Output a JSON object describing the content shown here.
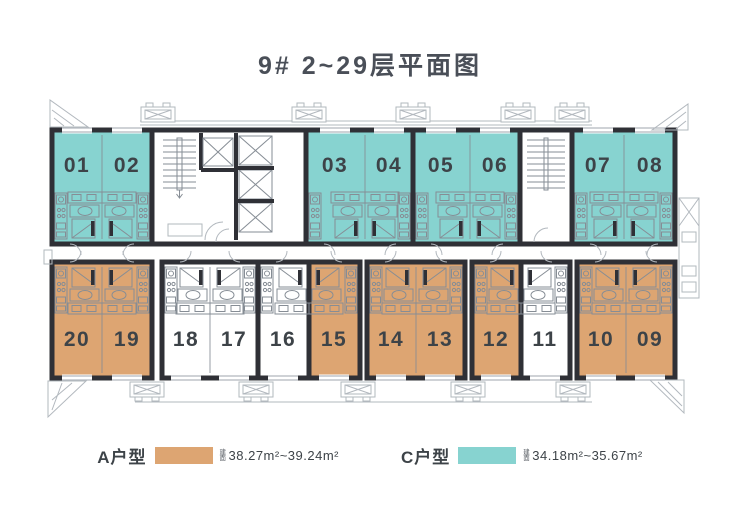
{
  "title": "9#  2~29层平面图",
  "units": {
    "top": [
      {
        "label": "01",
        "type": "C"
      },
      {
        "label": "02",
        "type": "C"
      },
      {
        "label": "03",
        "type": "C"
      },
      {
        "label": "04",
        "type": "C"
      },
      {
        "label": "05",
        "type": "C"
      },
      {
        "label": "06",
        "type": "C"
      },
      {
        "label": "07",
        "type": "C"
      },
      {
        "label": "08",
        "type": "C"
      }
    ],
    "bottom": [
      {
        "label": "20",
        "type": "A"
      },
      {
        "label": "19",
        "type": "A"
      },
      {
        "label": "18",
        "type": ""
      },
      {
        "label": "17",
        "type": ""
      },
      {
        "label": "16",
        "type": ""
      },
      {
        "label": "15",
        "type": "A"
      },
      {
        "label": "14",
        "type": "A"
      },
      {
        "label": "13",
        "type": "A"
      },
      {
        "label": "12",
        "type": "A"
      },
      {
        "label": "11",
        "type": ""
      },
      {
        "label": "10",
        "type": "A"
      },
      {
        "label": "09",
        "type": "A"
      }
    ]
  },
  "legend": [
    {
      "name": "A户型",
      "area_prefix": "建面",
      "area": "38.27m²~39.24m²"
    },
    {
      "name": "C户型",
      "area_prefix": "建面",
      "area": "34.18m²~35.67m²"
    }
  ],
  "colors": {
    "type-a": "#dda572",
    "type-c": "#87d3d0",
    "wall": "#2f3036",
    "line": "#868d95",
    "line-light": "#b2b8be",
    "number": "#3d4348",
    "title": "#4a4f58",
    "text": "#3d4348"
  }
}
